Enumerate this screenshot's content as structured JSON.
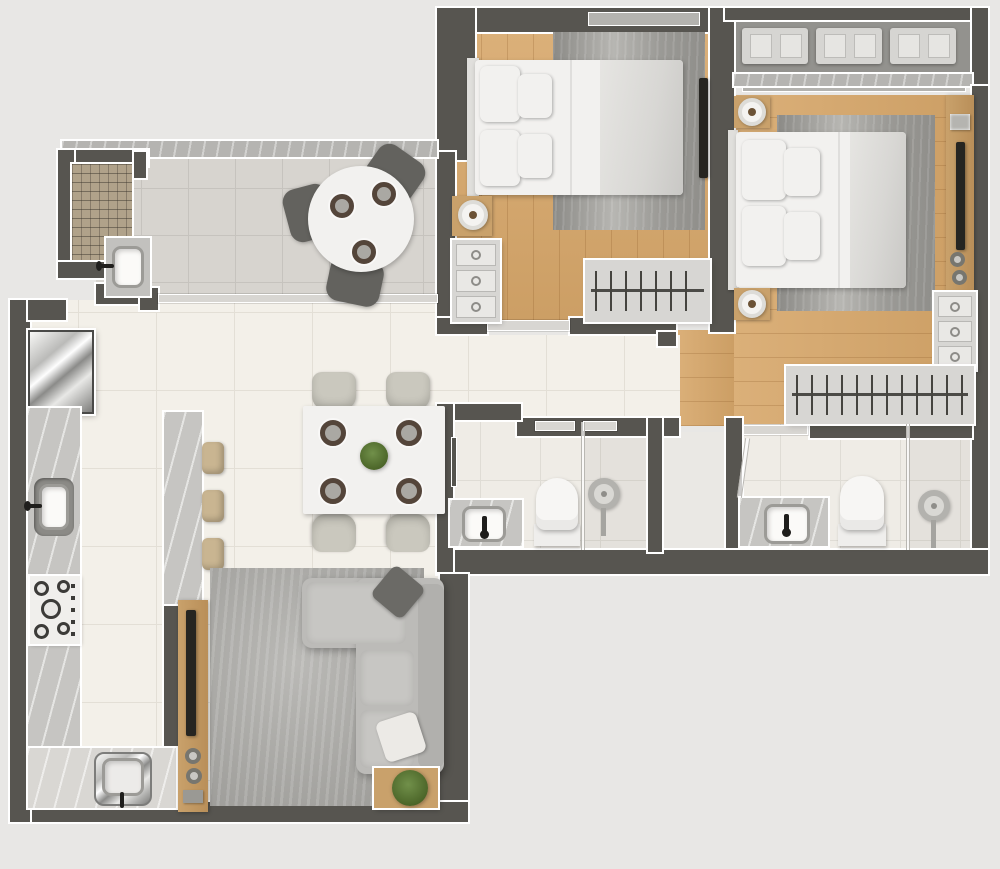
{
  "scene": {
    "type": "3d-floor-plan-render",
    "description": "Top-down 3D architectural render of a two-bedroom apartment floor plan with no text labels",
    "width_px": 1000,
    "height_px": 869
  },
  "palette": {
    "bg": "#e8e7e5",
    "wall": "#575550",
    "outline": "#ffffff",
    "floor-main": "#f3f0e9",
    "floor-main-line": "#e3dfd6",
    "floor-tile": "#d7d4cf",
    "floor-tile-line": "#c6c3be",
    "floor-bath": "#efece6",
    "floor-bath-line": "#dfdcd5",
    "wood": "#d7a76a",
    "granite": "#c6c5c2",
    "granite-dark": "#b5b4b1",
    "light-strip": "#d8d6d2",
    "rug-living": "#abaaa6",
    "rack-panel": "#d7d6d3",
    "rack-tan": "#b0a28a",
    "tech-floor": "#93928e",
    "bench": "#d6d5d2",
    "sofa": "#bcbbb8",
    "cushion": "#c7c6c3",
    "duvet": "#d8d7d4",
    "wood-panel": "#c9a16b",
    "tv": "#262521",
    "stool": "#c9b591",
    "chair": "#cac8be",
    "balcony-chair": "#63625e",
    "plate-rim": "#54453a",
    "plant-green": "#4c6629",
    "pillow-dark": "#6b6a66",
    "pillow-white": "#eceae6",
    "shaft-floor": "#eae8e4"
  },
  "rooms": [
    {
      "id": "service-balcony",
      "furniture": [
        "granite-parapet",
        "drying-rack",
        "laundry-sink",
        "round-table",
        "balcony-chair-x3",
        "place-setting-x3",
        "sliding-door"
      ]
    },
    {
      "id": "bedroom-1",
      "furniture": [
        "window",
        "double-bed",
        "area-rug",
        "nightstand-lamp",
        "three-drawer-dresser",
        "wall-tv",
        "open-clothes-rack",
        "sliding-door"
      ]
    },
    {
      "id": "tech-balcony",
      "furniture": [
        "ac-condenser-x3",
        "granite-sill",
        "window-line"
      ]
    },
    {
      "id": "bedroom-2",
      "furniture": [
        "double-bed",
        "area-rug",
        "nightstand-lamp-x2",
        "media-side-panel",
        "wall-tv",
        "wall-light",
        "knob-x2",
        "three-drawer-dresser",
        "open-clothes-rack",
        "sliding-door-to-ensuite"
      ]
    },
    {
      "id": "hallway",
      "furniture": [
        "bedroom-1-door-track",
        "bathroom-door-track",
        "shaft-door-track",
        "door-jamb"
      ]
    },
    {
      "id": "bathroom-1",
      "furniture": [
        "towel-bar",
        "vanity-counter",
        "basin",
        "faucet",
        "toilet",
        "shower-head",
        "glass-partition"
      ]
    },
    {
      "id": "service-shaft",
      "furniture": []
    },
    {
      "id": "bathroom-2",
      "furniture": [
        "vanity-counter",
        "basin",
        "faucet",
        "toilet",
        "shower-head",
        "glass-partition",
        "glass-door-panel"
      ]
    },
    {
      "id": "kitchen",
      "furniture": [
        "refrigerator",
        "left-counter",
        "ceramic-sink",
        "cooktop-five-burner",
        "bottom-counter",
        "steel-sink",
        "peninsula-counter",
        "bar-stool-x3"
      ]
    },
    {
      "id": "dining-area",
      "furniture": [
        "dining-table",
        "dining-chair-x4",
        "place-setting-x4",
        "centerpiece-plant"
      ]
    },
    {
      "id": "living-room",
      "furniture": [
        "l-shaped-sofa",
        "chaise",
        "seat-cushion-x2",
        "dark-throw-pillow",
        "white-throw-pillow",
        "area-rug",
        "media-wood-panel",
        "wall-tv",
        "speaker-x2",
        "side-table",
        "potted-plant"
      ]
    }
  ]
}
